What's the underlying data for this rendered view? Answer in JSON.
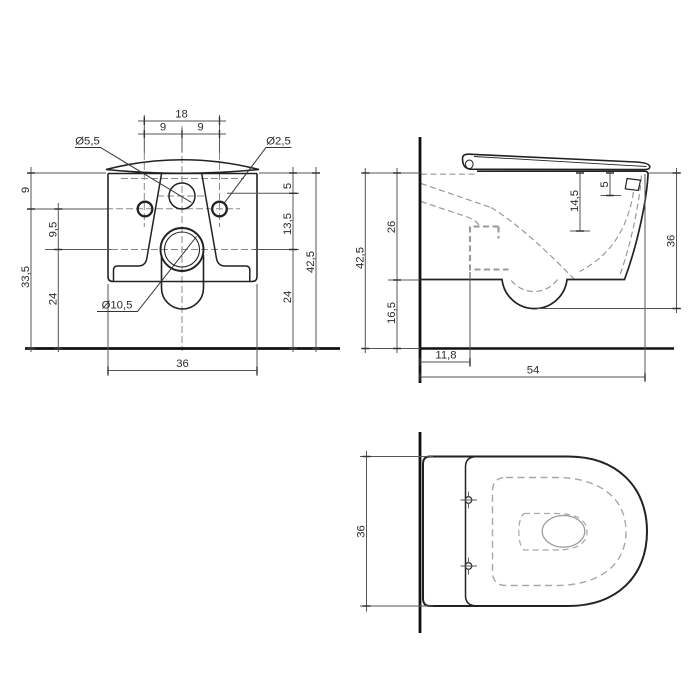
{
  "drawing": {
    "front_view": {
      "hole_spacing_total": "18",
      "hole_spacing_left": "9",
      "hole_spacing_right": "9",
      "dia_inlet_hole": "Ø5,5",
      "dia_fixing_hole": "Ø2,5",
      "dia_outlet_hole": "Ø10,5",
      "height_top_to_fixing": "9",
      "height_fixing_to_floor": "33,5",
      "height_fixing_to_outlet": "9,5",
      "height_outlet_to_floor_left": "24",
      "height_top_to_inlet": "5",
      "height_inlet_to_outlet": "13,5",
      "height_outlet_to_floor_right": "24",
      "height_total": "42,5",
      "width_body": "36"
    },
    "side_view": {
      "height_total": "42,5",
      "height_bowl": "26",
      "height_below_bowl": "16,5",
      "depth_rim_inner": "14,5",
      "depth_hinge_hole": "5",
      "height_front": "36",
      "offset_outlet_from_wall": "11,8",
      "depth_total": "54"
    },
    "top_view": {
      "width_body": "36"
    }
  }
}
